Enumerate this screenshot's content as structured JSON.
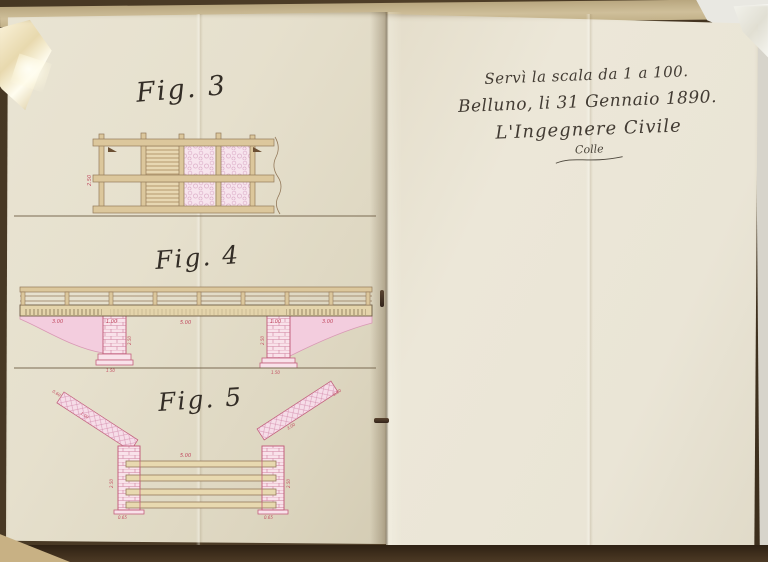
{
  "page_right": {
    "inscription_line1": "Servì la scala da 1 a 100.",
    "inscription_line2": "Belluno, li 31 Gennaio 1890.",
    "inscription_line3": "L'Ingegnere Civile",
    "signature": "Colle"
  },
  "page_left": {
    "fig3": {
      "label": "Fig. 3",
      "dim_height": "2.50"
    },
    "fig4": {
      "label": "Fig. 4",
      "dim_left_slope": "3.00",
      "dim_left_pier_w": "1.00",
      "dim_span": "5.00",
      "dim_right_pier_w": "1.00",
      "dim_right_slope": "3.00",
      "dim_left_pier_h": "2.50",
      "dim_right_pier_h": "2.50",
      "dim_left_footing": "1.50",
      "dim_right_footing": "1.50"
    },
    "fig5": {
      "label": "Fig. 5",
      "dim_span": "5.00",
      "dim_left_wing_cap": "0.60",
      "dim_left_wing": "1.00",
      "dim_right_wing_cap": "0.60",
      "dim_right_wing": "3.00",
      "dim_left_pier_h": "2.50",
      "dim_right_pier_h": "2.50",
      "dim_left_pier_w": "0.65",
      "dim_right_pier_w": "0.65"
    }
  },
  "colors": {
    "paper": "#e8e2d0",
    "ink": "#3c362e",
    "timber_brown": "#93795a",
    "masonry_pink": "#e8a9c0",
    "dimension_red": "#c0485e",
    "table_brown": "#4a3a26"
  }
}
